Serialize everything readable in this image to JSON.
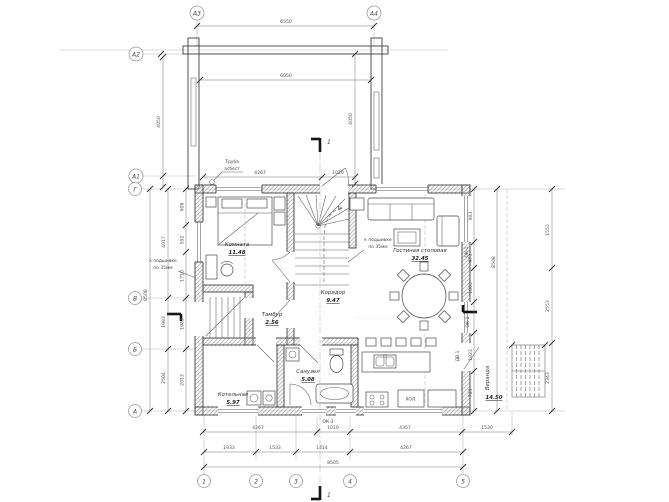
{
  "colors": {
    "line": "#3f3f3f",
    "light": "#b8b8b8",
    "wall_hatch": "#9a9a9a",
    "section_bold": "#141414",
    "background": "#ffffff"
  },
  "axes": {
    "top": [
      "А3",
      "А4"
    ],
    "left_upper": [
      "А2",
      "А1"
    ],
    "left": [
      "Г",
      "В",
      "Б",
      "А"
    ],
    "bottom": [
      "1",
      "2",
      "3",
      "4",
      "5"
    ]
  },
  "rooms": {
    "bedroom": {
      "name": "Комната",
      "area": "11.48"
    },
    "living": {
      "name": "Гостиная столовая",
      "area": "32.45"
    },
    "corridor": {
      "name": "Коридор",
      "area": "9.47"
    },
    "vestibule": {
      "name": "Тамбур",
      "area": "2.56"
    },
    "boiler": {
      "name": "Котельная",
      "area": "5.97"
    },
    "bathroom": {
      "name": "Санузел",
      "area": "5.08"
    },
    "veranda": {
      "name": "Веранда",
      "area": "14.50"
    }
  },
  "marks": {
    "ok1": "ОК-1",
    "ok2": "ОК-2",
    "ok3": "ОК-3",
    "dv1": "ДВ-1",
    "fridge": "ХОЛ.",
    "section": "1"
  },
  "annotations": {
    "pipe_l1": "Труба",
    "pipe_l2": "асбест",
    "siding_l1": "к подшивке",
    "siding_l2": "по 35мм"
  },
  "dims": {
    "terrace_outer": "6550",
    "terrace_inner": "6050",
    "terrace_left_h": "4050",
    "terrace_right_h": "4050",
    "top_inner": [
      "4267",
      "1010"
    ],
    "left_overall": "8508",
    "left_segments": [
      "4017",
      "1983",
      "2504"
    ],
    "left_small": [
      "908",
      "502",
      "1710",
      "1983",
      "2013"
    ],
    "right_overall": "8508",
    "right_segments": [
      "1553",
      "2553",
      "2343"
    ],
    "right_small": [
      "903",
      "973",
      "1003",
      "803",
      "1023",
      "703"
    ],
    "bottom_row1": [
      "4267",
      "1010",
      "4357",
      "1530"
    ],
    "bottom_row2": [
      "1933",
      "1533",
      "1414",
      "4267"
    ],
    "bottom_overall": "8505"
  }
}
